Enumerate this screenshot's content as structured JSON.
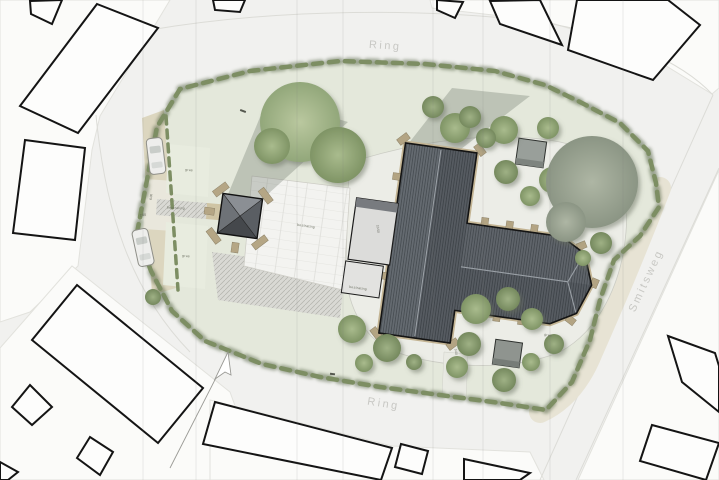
{
  "streets": {
    "ring_top": "Ring",
    "ring_bottom": "Ring",
    "smitsweg": "Smitsweg"
  },
  "labels": {
    "grass": "gras",
    "paving": "bestrating",
    "paving_note": "bestrating"
  },
  "dimensions": {
    "d1": "2.00",
    "d2": "6.00",
    "d3": "10.50",
    "d4": "5.00",
    "d5": "3.00"
  },
  "colors": {
    "road": "#f1f1ef",
    "block": "#fbfbf9",
    "lawn": "#e4e8db",
    "hedge": "#7d8e63",
    "sidewalk": "#e7e3d4",
    "plaza": "#f3f3f0",
    "path_tan": "#cfc4a4",
    "parking": "#dcd6bf",
    "apron": "#ecede7",
    "roof_dark": "#565b61",
    "roof_fascia": "#c3b493",
    "tower_roof": "#6e7277",
    "annex": "#dcdcda",
    "shed": "#999f9a",
    "tree": "#8da572",
    "outline": "#1a1a1a"
  }
}
